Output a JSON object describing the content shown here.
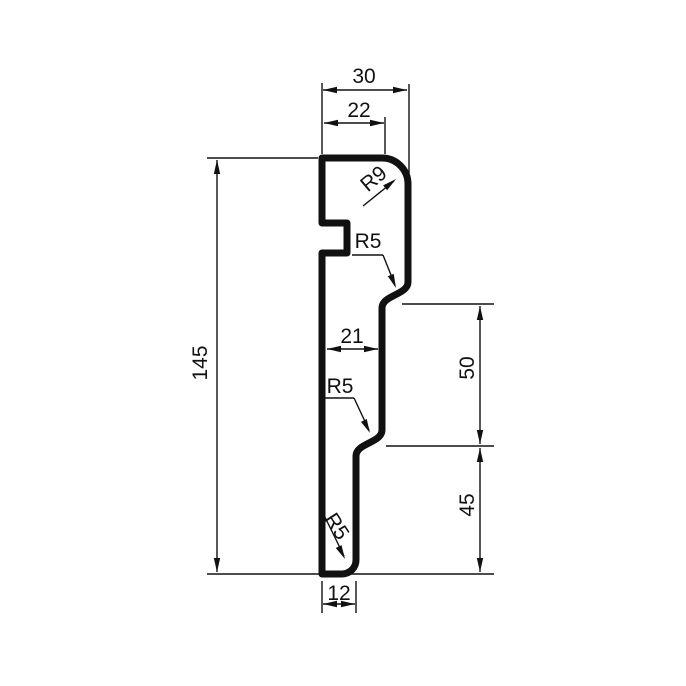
{
  "drawing": {
    "title": "Skirting profile cross-section with dimensions",
    "units_scale_px_per_unit": 2.87,
    "colors": {
      "background": "#ffffff",
      "line": "#111111"
    },
    "dimensions": {
      "top_width": "30",
      "top_flat_width": "22",
      "total_height": "145",
      "middle_width": "21",
      "upper_step_height": "50",
      "lower_step_height": "45",
      "bottom_width": "12"
    },
    "radius_labels": {
      "top_corner": "R9",
      "upper_step": "R5",
      "lower_step": "R5",
      "bottom_corner": "R5"
    }
  }
}
